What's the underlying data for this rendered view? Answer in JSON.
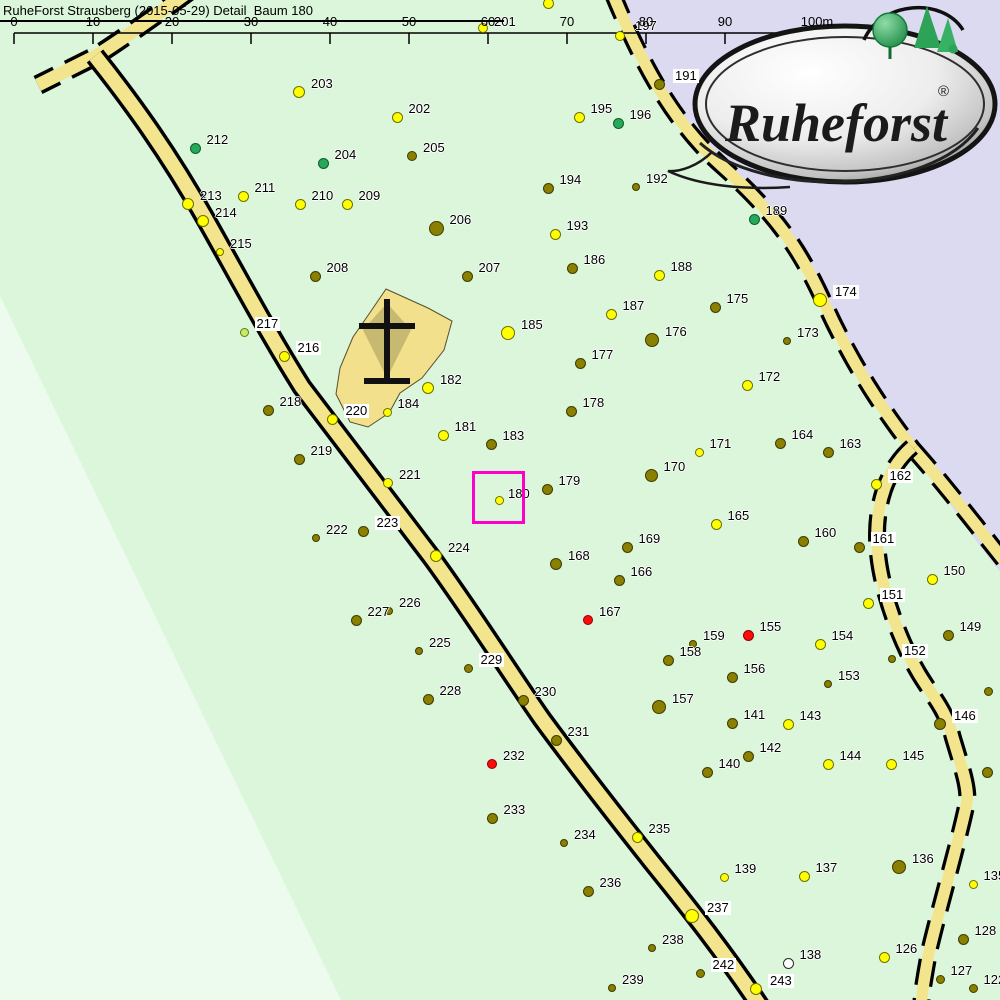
{
  "title": "RuheForst Strausberg (2015-05-29) Detail  Baum 180",
  "logo": {
    "wordmark": "Ruheforst",
    "registered": "®"
  },
  "scalebar": {
    "labels": [
      "0",
      "10",
      "20",
      "30",
      "40",
      "50",
      "60",
      "70",
      "80",
      "90",
      "100m"
    ],
    "x0": 14,
    "step": 79,
    "y_line": 33,
    "tick_len": 11,
    "label_top": 14
  },
  "colors": {
    "background": "#DBF6DB",
    "pale_area": "#EDFBEE",
    "outside_area": "#DBDAF0",
    "road_fill": "#F3E58E",
    "road_casing": "#000000",
    "memorial_fill": "#F2E08C",
    "memorial_inner": "#C7BA70",
    "cross": "#111111",
    "scale_line": "#000000",
    "label_bg": "#FFFFFF",
    "highlight": "#FF00CC"
  },
  "dot_palette": {
    "y": {
      "fill": "#FFFF00",
      "stroke": "#6E6E00"
    },
    "o": {
      "fill": "#8A8000",
      "stroke": "#3E3A00"
    },
    "g": {
      "fill": "#28A85A",
      "stroke": "#0C5F2C"
    },
    "lg": {
      "fill": "#C8EA66",
      "stroke": "#5C7C10"
    },
    "r": {
      "fill": "#FF0A0A",
      "stroke": "#8A0000"
    },
    "w": {
      "fill": "#FFFFFF",
      "stroke": "#2A2A2A"
    }
  },
  "highlight_box": {
    "tree": "180",
    "x": 472,
    "y": 471,
    "size": 53,
    "border": 3
  },
  "tree_fields": [
    "label",
    "x",
    "y",
    "color",
    "radius",
    "label_bg",
    "label_dx",
    "label_dy"
  ],
  "trees": [
    [
      "198",
      548,
      3,
      "y",
      5.5,
      0,
      10,
      -16
    ],
    [
      "201",
      483,
      28,
      "y",
      5,
      0,
      11,
      -13
    ],
    [
      "197",
      620,
      36,
      "y",
      5,
      0,
      15,
      -17
    ],
    [
      "195",
      579,
      117,
      "y",
      5.5,
      0
    ],
    [
      "196",
      618,
      123,
      "g",
      5.5,
      0
    ],
    [
      "191",
      659,
      84,
      "o",
      5.5,
      1,
      14,
      -15
    ],
    [
      "192",
      636,
      187,
      "o",
      4,
      0
    ],
    [
      "194",
      548,
      188,
      "o",
      5.5,
      0
    ],
    [
      "193",
      555,
      234,
      "y",
      5.5,
      0
    ],
    [
      "203",
      299,
      92,
      "y",
      6,
      0
    ],
    [
      "202",
      397,
      117,
      "y",
      5.5,
      0
    ],
    [
      "204",
      323,
      163,
      "g",
      5.5,
      0
    ],
    [
      "205",
      412,
      156,
      "o",
      5,
      0
    ],
    [
      "212",
      195,
      148,
      "g",
      5.5,
      0
    ],
    [
      "211",
      243,
      196,
      "y",
      5.5,
      0
    ],
    [
      "213",
      188,
      204,
      "y",
      6,
      0
    ],
    [
      "214",
      203,
      221,
      "y",
      6,
      0
    ],
    [
      "215",
      220,
      252,
      "y",
      4,
      0
    ],
    [
      "210",
      300,
      204,
      "y",
      5.5,
      0
    ],
    [
      "209",
      347,
      204,
      "y",
      5.5,
      0
    ],
    [
      "206",
      436,
      228,
      "o",
      7.5,
      0
    ],
    [
      "207",
      467,
      276,
      "o",
      5.5,
      0
    ],
    [
      "208",
      315,
      276,
      "o",
      5.5,
      0
    ],
    [
      "189",
      754,
      219,
      "g",
      5.5,
      0
    ],
    [
      "188",
      659,
      275,
      "y",
      5.5,
      0
    ],
    [
      "187",
      611,
      314,
      "y",
      5.5,
      0
    ],
    [
      "186",
      572,
      268,
      "o",
      5.5,
      0
    ],
    [
      "185",
      508,
      333,
      "y",
      7,
      0
    ],
    [
      "175",
      715,
      307,
      "o",
      5.5,
      0
    ],
    [
      "176",
      652,
      340,
      "o",
      7,
      0
    ],
    [
      "177",
      580,
      363,
      "o",
      5.5,
      0
    ],
    [
      "174",
      820,
      300,
      "y",
      7,
      1
    ],
    [
      "173",
      787,
      341,
      "o",
      4,
      0
    ],
    [
      "172",
      747,
      385,
      "y",
      5.5,
      0
    ],
    [
      "178",
      571,
      411,
      "o",
      5.5,
      0
    ],
    [
      "171",
      699,
      452,
      "y",
      4.5,
      0
    ],
    [
      "164",
      780,
      443,
      "o",
      5.5,
      0
    ],
    [
      "163",
      828,
      452,
      "o",
      5.5,
      0
    ],
    [
      "162",
      876,
      484,
      "y",
      5.5,
      1
    ],
    [
      "170",
      651,
      475,
      "o",
      6.5,
      0
    ],
    [
      "179",
      547,
      489,
      "o",
      5.5,
      0
    ],
    [
      "183",
      491,
      444,
      "o",
      5.5,
      0
    ],
    [
      "181",
      443,
      435,
      "y",
      5.5,
      0
    ],
    [
      "182",
      428,
      388,
      "y",
      6,
      0
    ],
    [
      "184",
      387,
      412,
      "y",
      4.5,
      0
    ],
    [
      "180",
      499,
      500,
      "y",
      4.5,
      0,
      9,
      -13
    ],
    [
      "216",
      284,
      356,
      "y",
      5.5,
      1
    ],
    [
      "217",
      244,
      332,
      "lg",
      4.5,
      1
    ],
    [
      "218",
      268,
      410,
      "o",
      5.5,
      0
    ],
    [
      "220",
      332,
      419,
      "y",
      5.5,
      1
    ],
    [
      "219",
      299,
      459,
      "o",
      5.5,
      0
    ],
    [
      "221",
      388,
      483,
      "y",
      5,
      0
    ],
    [
      "222",
      316,
      538,
      "o",
      4,
      0
    ],
    [
      "223",
      363,
      531,
      "o",
      5.5,
      1
    ],
    [
      "224",
      436,
      556,
      "y",
      6,
      0
    ],
    [
      "168",
      556,
      564,
      "o",
      6,
      0
    ],
    [
      "166",
      619,
      580,
      "o",
      5.5,
      0
    ],
    [
      "169",
      627,
      547,
      "o",
      5.5,
      0
    ],
    [
      "165",
      716,
      524,
      "y",
      5.5,
      0
    ],
    [
      "160",
      803,
      541,
      "o",
      5.5,
      0
    ],
    [
      "161",
      859,
      547,
      "o",
      5.5,
      1
    ],
    [
      "151",
      868,
      603,
      "y",
      5.5,
      1
    ],
    [
      "150",
      932,
      579,
      "y",
      5.5,
      0
    ],
    [
      "149",
      948,
      635,
      "o",
      5.5,
      0
    ],
    [
      "167",
      588,
      620,
      "r",
      5,
      0
    ],
    [
      "155",
      748,
      635,
      "r",
      5.5,
      0
    ],
    [
      "159",
      693,
      644,
      "o",
      4,
      0
    ],
    [
      "158",
      668,
      660,
      "o",
      5.5,
      0
    ],
    [
      "154",
      820,
      644,
      "y",
      5.5,
      0
    ],
    [
      "156",
      732,
      677,
      "o",
      5.5,
      0
    ],
    [
      "153",
      828,
      684,
      "o",
      4,
      0
    ],
    [
      "152",
      892,
      659,
      "o",
      4,
      1
    ],
    [
      "157",
      659,
      707,
      "o",
      7,
      0
    ],
    [
      "141",
      732,
      723,
      "o",
      5.5,
      0
    ],
    [
      "143",
      788,
      724,
      "y",
      5.5,
      0
    ],
    [
      "146",
      940,
      724,
      "o",
      6,
      1
    ],
    [
      "142",
      748,
      756,
      "o",
      5.5,
      0
    ],
    [
      "140",
      707,
      772,
      "o",
      5.5,
      0
    ],
    [
      "144",
      828,
      764,
      "y",
      5.5,
      0
    ],
    [
      "145",
      891,
      764,
      "y",
      5.5,
      0
    ],
    [
      "",
      988,
      691,
      "o",
      4.5,
      0
    ],
    [
      "",
      987,
      772,
      "o",
      5.5,
      0
    ],
    [
      "227",
      356,
      620,
      "o",
      5.5,
      0
    ],
    [
      "226",
      389,
      611,
      "o",
      4,
      0
    ],
    [
      "225",
      419,
      651,
      "o",
      4,
      0
    ],
    [
      "229",
      468,
      668,
      "o",
      4.5,
      1
    ],
    [
      "228",
      428,
      699,
      "o",
      5.5,
      0
    ],
    [
      "230",
      523,
      700,
      "o",
      5.5,
      0
    ],
    [
      "231",
      556,
      740,
      "o",
      5.5,
      0
    ],
    [
      "232",
      492,
      764,
      "r",
      5,
      0
    ],
    [
      "233",
      492,
      818,
      "o",
      5.5,
      0
    ],
    [
      "234",
      564,
      843,
      "o",
      4,
      0
    ],
    [
      "235",
      637,
      837,
      "y",
      5.5,
      0
    ],
    [
      "236",
      588,
      891,
      "o",
      5.5,
      0
    ],
    [
      "237",
      692,
      916,
      "y",
      7,
      1
    ],
    [
      "238",
      652,
      948,
      "o",
      4,
      0
    ],
    [
      "239",
      612,
      988,
      "o",
      4,
      0
    ],
    [
      "242",
      700,
      973,
      "o",
      4.5,
      1
    ],
    [
      "243",
      756,
      989,
      "y",
      6,
      1
    ],
    [
      "139",
      724,
      877,
      "y",
      4.5,
      0
    ],
    [
      "137",
      804,
      876,
      "y",
      5.5,
      0
    ],
    [
      "138",
      788,
      963,
      "w",
      5.5,
      0
    ],
    [
      "136",
      899,
      867,
      "o",
      7,
      0
    ],
    [
      "135",
      973,
      884,
      "y",
      4.5,
      0
    ],
    [
      "128",
      963,
      939,
      "o",
      5.5,
      0
    ],
    [
      "126",
      884,
      957,
      "y",
      5.5,
      0
    ],
    [
      "127",
      940,
      979,
      "o",
      4.5,
      0
    ],
    [
      "122",
      973,
      988,
      "o",
      4.5,
      0
    ]
  ],
  "map": {
    "areas": [
      {
        "name": "pale-forest-wedge",
        "path": "M 0,296 L 341,1000 L 0,1000 Z",
        "fill_key": "pale_area"
      },
      {
        "name": "outside-boundary-area",
        "path": "M 648,0 L 1002,0 L 1002,574 C 970,535 940,490 913,449 C 876,402 846,352 823,300 C 800,250 776,214 722,166 C 672,122 640,60 618,-5 Z",
        "fill_key": "outside_area"
      }
    ],
    "memorial": {
      "outline": "M 386,289 L 428,308 L 452,321 L 444,350 L 422,378 L 400,393 L 389,413 L 368,427 L 350,422 L 336,394 L 340,368 L 353,337 L 369,314 Z",
      "kite": "M 387,303 L 363,330 L 387,378 L 411,330 Z",
      "cross_lines": [
        "M 387,299 L 387,384",
        "M 359,326 L 415,326",
        "M 364,381 L 410,381"
      ],
      "cross_width": 6
    },
    "roads": [
      {
        "name": "road-north-branch",
        "path": "M 188,-8 C 158,14 118,42 96,56 L 38,85",
        "casing": 20,
        "fill": 13,
        "dash": "26 13"
      },
      {
        "name": "road-main",
        "path": "M 95,56 C 130,100 168,152 205,218 C 240,280 268,333 302,387 C 342,440 388,500 432,558 C 472,613 508,670 542,719 C 578,768 614,814 652,862 C 690,909 726,955 760,1006",
        "casing": 21,
        "fill": 14,
        "dash": ""
      },
      {
        "name": "road-top-right",
        "path": "M 612,-8 C 640,60 672,122 722,166 C 776,214 800,250 823,300 C 846,352 876,402 913,449",
        "casing": 18,
        "fill": 11.5,
        "dash": "26 13"
      },
      {
        "name": "road-branch-east",
        "path": "M 913,449 C 945,485 978,528 1010,568",
        "casing": 18,
        "fill": 11.5,
        "dash": "26 13"
      },
      {
        "name": "road-right-s",
        "path": "M 912,447 C 888,468 877,500 877,535 C 877,572 890,615 908,653 C 926,692 944,702 953,738 C 961,765 969,787 967,802 C 958,845 940,905 929,952 C 925,975 922,990 921,1008",
        "casing": 18,
        "fill": 11.5,
        "dash": "26 13"
      }
    ]
  }
}
